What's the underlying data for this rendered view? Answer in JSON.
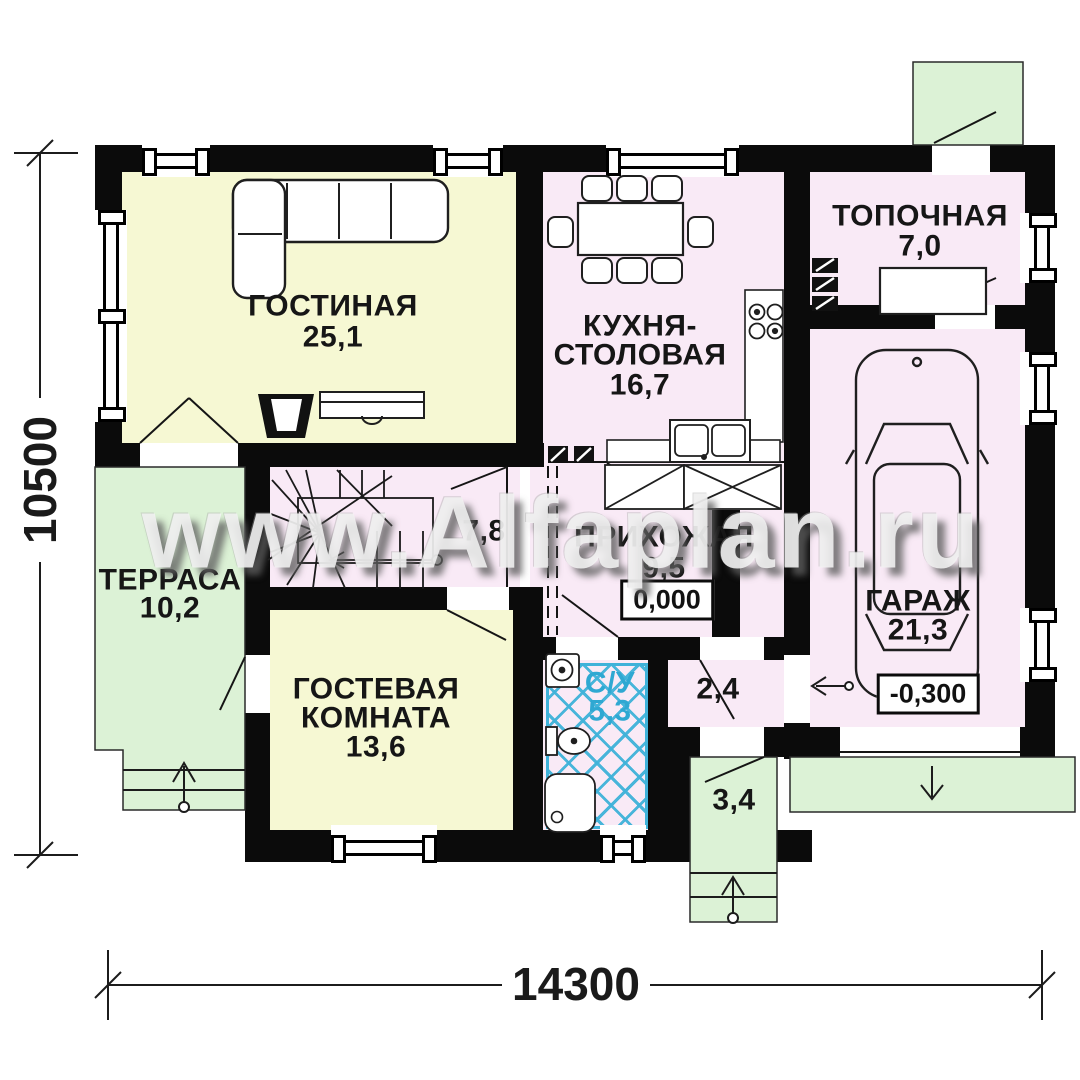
{
  "watermark": {
    "text": "www.Alfaplan.ru"
  },
  "dimensions": {
    "height_label": "10500",
    "width_label": "14300"
  },
  "elevations": {
    "main_floor": "0,000",
    "garage": "-0,300"
  },
  "rooms": {
    "living": {
      "name": "ГОСТИНАЯ",
      "area": "25,1"
    },
    "kitchen_dining": {
      "name_line1": "КУХНЯ-",
      "name_line2": "СТОЛОВАЯ",
      "area": "16,7"
    },
    "boiler": {
      "name": "ТОПОЧНАЯ",
      "area": "7,0"
    },
    "garage": {
      "name": "ГАРАЖ",
      "area": "21,3"
    },
    "hallway": {
      "name": "ПРИХОЖАЯ",
      "area": "9,5"
    },
    "bathroom": {
      "name": "С/У",
      "area": "5,3"
    },
    "stair_hall": {
      "area": "7,8"
    },
    "terrace": {
      "name": "ТЕРРАСА",
      "area": "10,2"
    },
    "guest": {
      "name_line1": "ГОСТЕВАЯ",
      "name_line2": "КОМНАТА",
      "area": "13,6"
    },
    "storage": {
      "area": "2,4"
    },
    "entry_porch": {
      "area": "3,4"
    }
  },
  "colors": {
    "warm_room": "#f6f8d3",
    "cool_room": "#f9eaf6",
    "outdoor": "#dcf2d6",
    "bath_hatch": "#3fb2d9",
    "wall": "#0b0b0b",
    "watermark_gray": "#f3f3f3"
  }
}
